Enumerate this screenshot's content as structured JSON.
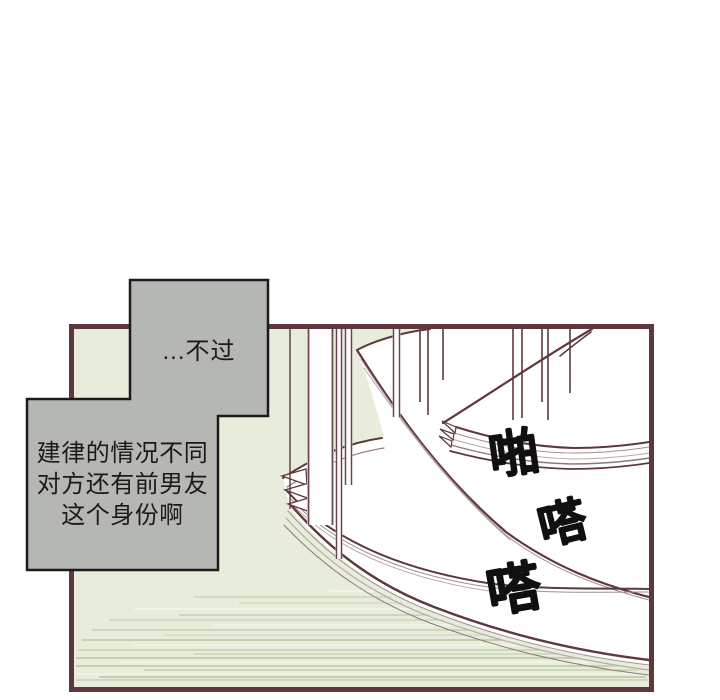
{
  "panel": {
    "border_color": "#5e383c",
    "background_color": "#e7edda"
  },
  "speech_bubbles": {
    "fill_color": "#b5b7b2",
    "border_color": "#1b1b1b",
    "text_color": "#1a1a1a",
    "bubble_top": {
      "text": "...不过"
    },
    "bubble_bottom": {
      "text": "建律的情况不同\n对方还有前男友\n这个身份啊"
    }
  },
  "sound_effects": {
    "color": "#101010",
    "chars": [
      "啪",
      "嗒",
      "嗒"
    ]
  },
  "artwork_colors": {
    "main_line": "#5e383c",
    "thin_line": "#a1908f",
    "page_fill": "#ffffff",
    "speed_line": "#bccaa6"
  }
}
